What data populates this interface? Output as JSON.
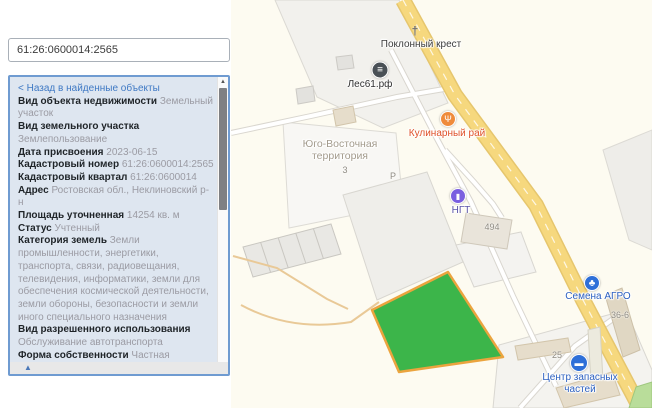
{
  "search": {
    "value": "61:26:0600014:2565"
  },
  "panel": {
    "back_link": "< Назад в найденные объекты",
    "collapse_icon": "▲",
    "scroll_up_icon": "▲",
    "fields": [
      {
        "label": "Вид объекта недвижимости",
        "value": "Земельный участок"
      },
      {
        "label": "Вид земельного участка",
        "value": "Землепользование"
      },
      {
        "label": "Дата присвоения",
        "value": "2023-06-15"
      },
      {
        "label": "Кадастровый номер",
        "value": "61:26:0600014:2565"
      },
      {
        "label": "Кадастровый квартал",
        "value": "61:26:0600014"
      },
      {
        "label": "Адрес",
        "value": "Ростовская обл., Неклиновский р-н"
      },
      {
        "label": "Площадь уточненная",
        "value": "14254 кв. м"
      },
      {
        "label": "Статус",
        "value": "Учтенный"
      },
      {
        "label": "Категория земель",
        "value": "Земли промышленности, энергетики, транспорта, связи, радиовещания, телевидения, информатики, земли для обеспечения космической деятельности, земли обороны, безопасности и земли иного специального назначения"
      },
      {
        "label": "Вид разрешенного использования",
        "value": "Обслуживание автотранспорта"
      },
      {
        "label": "Форма собственности",
        "value": "Частная"
      },
      {
        "label": "Кадастровая стоимость",
        "value": "6991301.92 руб."
      },
      {
        "label": "Удельный показатель кадастровой стоимости",
        "value": "490.48 руб./кв. м"
      }
    ]
  },
  "map": {
    "pois": [
      {
        "id": "poklonny-krest",
        "label": [
          "Поклонный крест"
        ],
        "label_color": "#3b3b3b",
        "icon": {
          "type": "plain",
          "glyph": "†",
          "color": "#6a6a6a",
          "x": 184,
          "y": 31,
          "size": 12
        },
        "label_x": 190,
        "label_y": 39
      },
      {
        "id": "les61-rf",
        "label": [
          "Лес61.рф"
        ],
        "label_color": "#2f2f2f",
        "icon": {
          "type": "circle",
          "glyph": "≡",
          "bg": "#495056",
          "x": 149,
          "y": 70,
          "size": 17,
          "glyph_size": 10
        },
        "label_x": 139,
        "label_y": 79
      },
      {
        "id": "kulinarny-ray",
        "label": [
          "Кулинарный рай"
        ],
        "label_color": "#df5129",
        "icon": {
          "type": "circle",
          "glyph": "Ψ",
          "bg": "#ef8b3b",
          "x": 217,
          "y": 119,
          "size": 16,
          "glyph_size": 9
        },
        "label_x": 216,
        "label_y": 128
      },
      {
        "id": "ngt-fuel-station",
        "label": [
          "НГТ"
        ],
        "label_color": "#5b54a8",
        "icon": {
          "type": "circle",
          "glyph": "▮",
          "bg": "#7a5fe0",
          "x": 227,
          "y": 196,
          "size": 16,
          "glyph_size": 8
        },
        "label_x": 230,
        "label_y": 205
      },
      {
        "id": "semena-agro",
        "label": [
          "Семена АГРО"
        ],
        "label_color": "#2b5fc0",
        "icon": {
          "type": "circle",
          "glyph": "♣",
          "bg": "#2e6fd8",
          "x": 361,
          "y": 283,
          "size": 16,
          "glyph_size": 10
        },
        "label_x": 367,
        "label_y": 291
      },
      {
        "id": "centr-zapasnyh-chastey",
        "label": [
          "Центр запасных",
          "частей"
        ],
        "label_color": "#2b5fc0",
        "icon": {
          "type": "circle",
          "glyph": "▬",
          "bg": "#2e6fd8",
          "x": 348,
          "y": 363,
          "size": 18,
          "glyph_size": 9
        },
        "label_x": 349,
        "label_y": 372
      }
    ],
    "area_label": {
      "lines": [
        "Юго-Восточная",
        "территория"
      ],
      "x": 109,
      "y": 139
    },
    "small_labels": [
      {
        "text": "3",
        "x": 114,
        "y": 165
      },
      {
        "text": "Р",
        "x": 162,
        "y": 171
      },
      {
        "text": "494",
        "x": 261,
        "y": 222
      },
      {
        "text": "36-6",
        "x": 389,
        "y": 310
      },
      {
        "text": "25",
        "x": 326,
        "y": 350
      }
    ]
  },
  "colors": {
    "selected_parcel_fill": "#3cb54a",
    "selected_parcel_border": "#eba43e",
    "road_fill": "#f6d87e",
    "road_casing": "#e6c66d",
    "panel_bg": "#dee6f0",
    "panel_border": "#6f9bd1",
    "link_color": "#3f79c4",
    "value_color": "#9b9ba3",
    "poi_blue": "#2e6fd8",
    "map_bg": "#fdfbf1"
  }
}
